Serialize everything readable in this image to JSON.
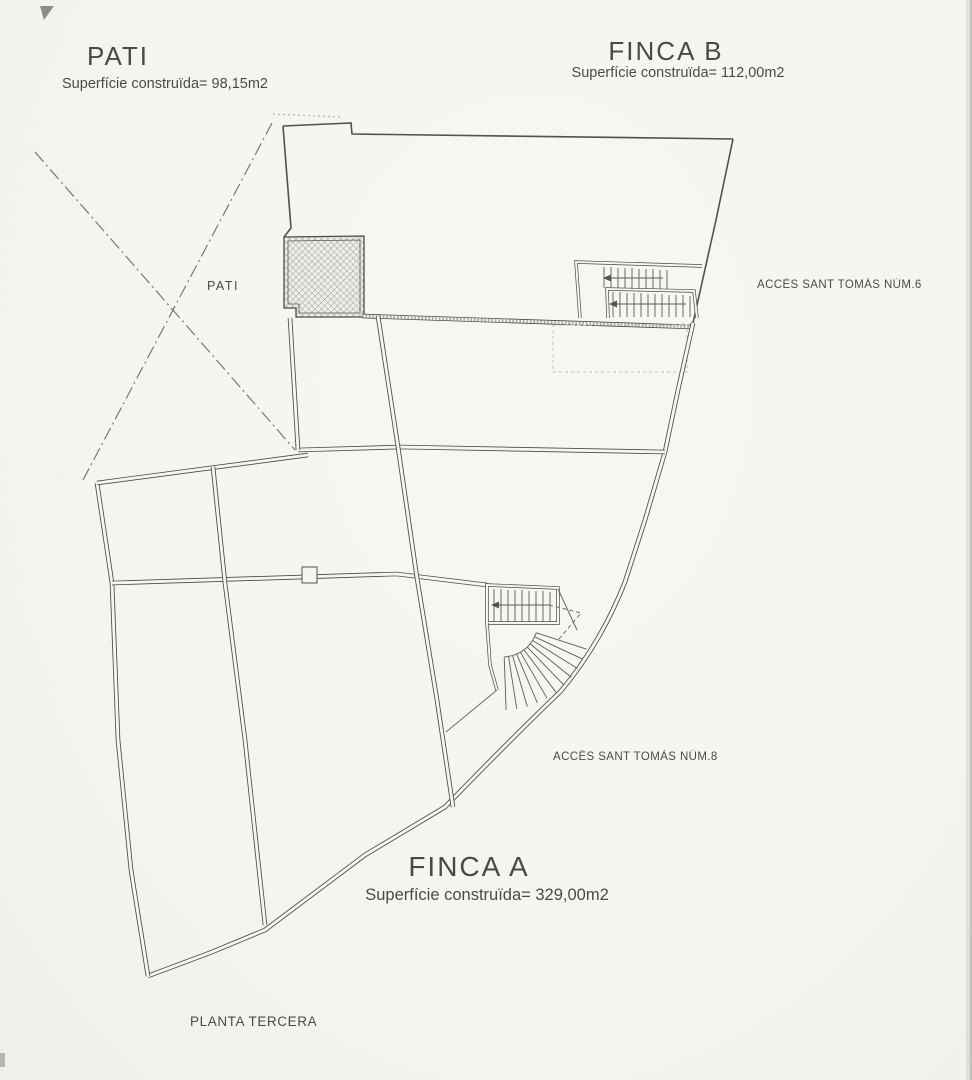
{
  "page": {
    "background_color": "#f5f4ef",
    "ink_color": "#403f3b",
    "drawing_type": "scanned architectural floor plan"
  },
  "plan": {
    "floor_label": "PLANTA TERCERA",
    "units": [
      {
        "id": "pati",
        "title": "PATI",
        "area_label": "Superfície construïda= 98,15m2",
        "area_m2": "98,15"
      },
      {
        "id": "finca_b",
        "title": "FINCA B",
        "area_label": "Superfície construïda= 112,00m2",
        "area_m2": "112,00"
      },
      {
        "id": "finca_a",
        "title": "FINCA A",
        "area_label": "Superfície construïda= 329,00m2",
        "area_m2": "329,00"
      }
    ],
    "room_labels": {
      "pati_room": "PATI"
    },
    "access_labels": {
      "num6": "ACCÉS SANT TOMÀS NÚM.6",
      "num8": "ACCÉS SANT TOMÀS NÚM.8"
    }
  }
}
